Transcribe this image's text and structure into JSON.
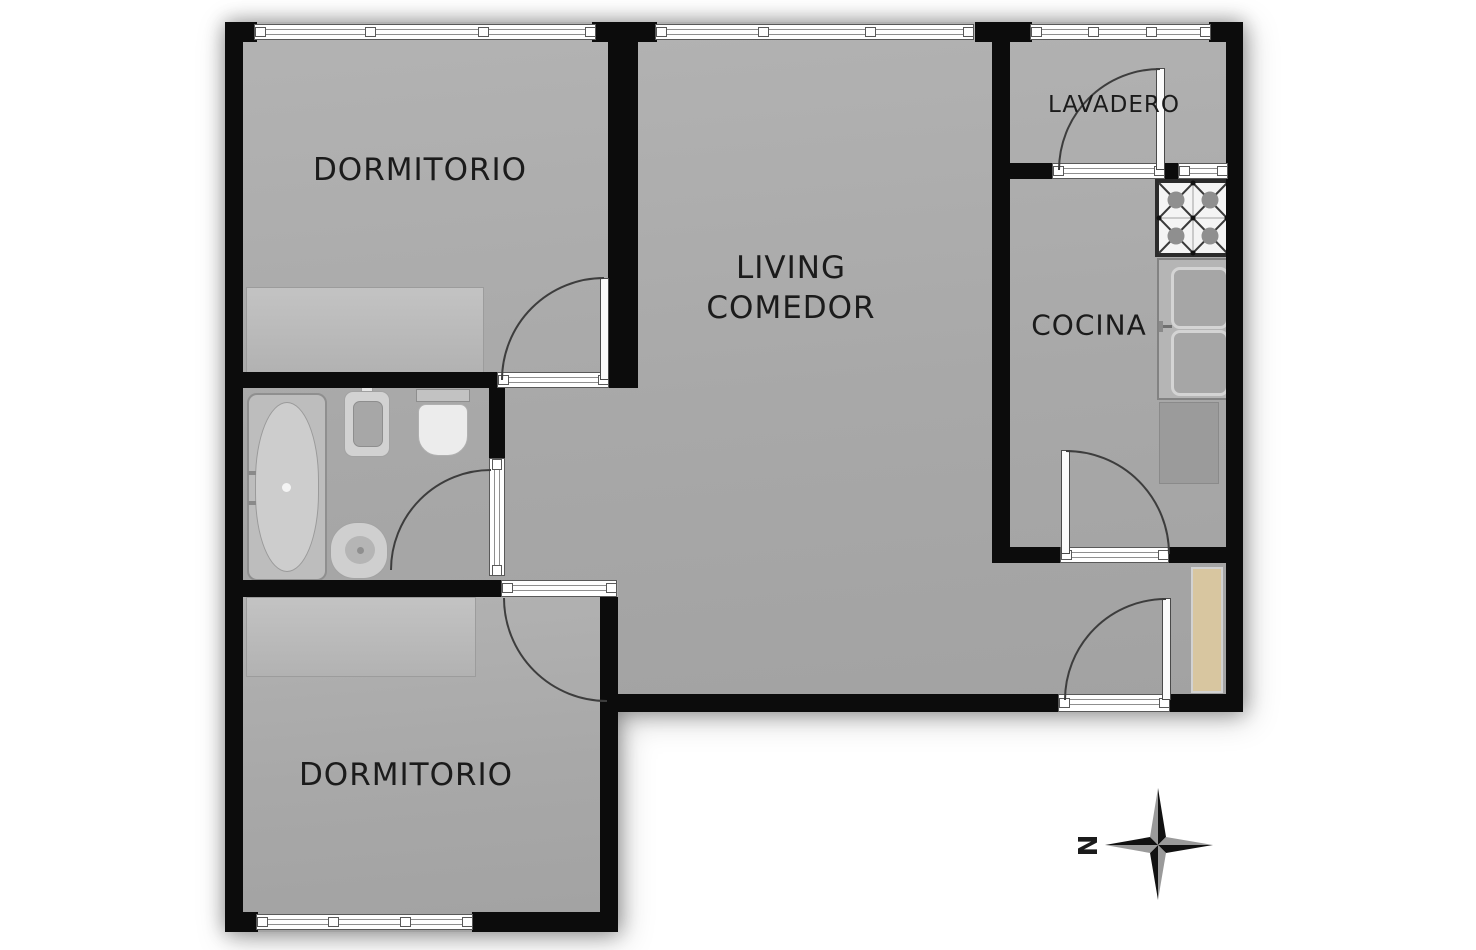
{
  "plan_title": "apartment-floor-plan",
  "rooms": {
    "bedroom1": {
      "label": "DORMITORIO"
    },
    "living": {
      "line1": "LIVING",
      "line2": "COMEDOR"
    },
    "lavadero": {
      "label": "LAVADERO"
    },
    "kitchen": {
      "label": "COCINA"
    },
    "bedroom2": {
      "label": "DORMITORIO"
    }
  },
  "compass": {
    "north": "N"
  },
  "fixtures": [
    "bathtub",
    "bidet",
    "toilet",
    "washbasin",
    "wardrobe",
    "wardrobe",
    "stove",
    "kitchen-sink",
    "kitchen-counter",
    "entry-wood-cabinet"
  ],
  "features": [
    "windows",
    "door-swings",
    "wall-openings"
  ],
  "colors": {
    "wall": "#0c0c0c",
    "floor": "#a8a8a8",
    "furniture": "#bcbcbc",
    "window_band": "#ffffff",
    "wood_cabinet": "#d8c6a0",
    "compass_dark": "#111111",
    "compass_gray": "#9a9a9a"
  }
}
